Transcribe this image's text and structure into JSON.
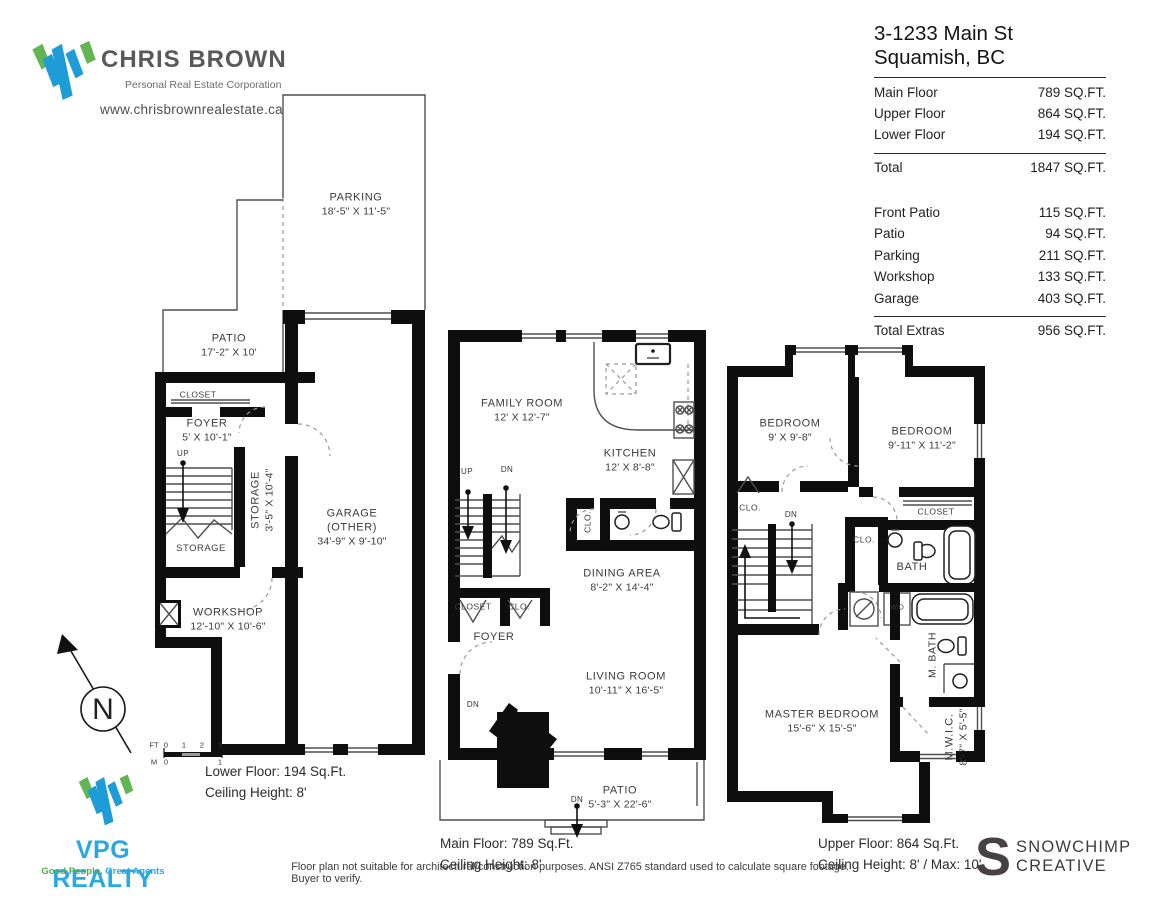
{
  "branding": {
    "agent_logo_name": "CHRIS BROWN",
    "agent_logo_subtitle": "Personal Real Estate Corporation",
    "agent_website": "www.chrisbrownrealestate.ca",
    "brokerage_name": "VPG REALTY",
    "brokerage_tagline_good": "Good People,",
    "brokerage_tagline_great": " Great Agents",
    "designer_initial": "S",
    "designer_name_line1": "SNOWCHIMP",
    "designer_name_line2": "CREATIVE",
    "colors": {
      "logo_blue": "#1e9cd7",
      "logo_green": "#63b553",
      "vpg_blue": "#29a9e1",
      "wall_black": "#0e0e0e"
    }
  },
  "header": {
    "address_line1": "3-1233 Main St",
    "address_line2": "Squamish, BC",
    "floors": [
      {
        "label": "Main Floor",
        "value": "789 SQ.FT."
      },
      {
        "label": "Upper Floor",
        "value": "864 SQ.FT."
      },
      {
        "label": "Lower Floor",
        "value": "194 SQ.FT."
      }
    ],
    "total": {
      "label": "Total",
      "value": "1847 SQ.FT."
    },
    "extras": [
      {
        "label": "Front Patio",
        "value": "115 SQ.FT."
      },
      {
        "label": "Patio",
        "value": "94 SQ.FT."
      },
      {
        "label": "Parking",
        "value": "211 SQ.FT."
      },
      {
        "label": "Workshop",
        "value": "133 SQ.FT."
      },
      {
        "label": "Garage",
        "value": "403 SQ.FT."
      }
    ],
    "total_extras": {
      "label": "Total Extras",
      "value": "956 SQ.FT."
    }
  },
  "plans": {
    "lower": {
      "parking": {
        "name": "PARKING",
        "dims": "18'-5\" X 11'-5\""
      },
      "patio": {
        "name": "PATIO",
        "dims": "17'-2\" X 10'"
      },
      "closet": {
        "name": "CLOSET"
      },
      "foyer": {
        "name": "FOYER",
        "dims": "5' X 10'-1\""
      },
      "storage_tall": {
        "name": "STORAGE",
        "dims": "3'-5\" X 10'-4\""
      },
      "storage": {
        "name": "STORAGE"
      },
      "garage": {
        "name": "GARAGE",
        "name2": "(OTHER)",
        "dims": "34'-9\" X 9'-10\""
      },
      "workshop": {
        "name": "WORKSHOP",
        "dims": "12'-10\" X 10'-6\""
      },
      "caption1": "Lower Floor: 194 Sq.Ft.",
      "caption2": "Ceiling Height: 8'"
    },
    "main": {
      "family": {
        "name": "FAMILY ROOM",
        "dims": "12' X 12'-7\""
      },
      "kitchen": {
        "name": "KITCHEN",
        "dims": "12' X 8'-8\""
      },
      "clo_rot": {
        "name": "CLO."
      },
      "dining": {
        "name": "DINING AREA",
        "dims": "8'-2\" X 14'-4\""
      },
      "closet": {
        "name": "CLOSET"
      },
      "clo": {
        "name": "CLO."
      },
      "foyer": {
        "name": "FOYER"
      },
      "living": {
        "name": "LIVING ROOM",
        "dims": "10'-11\" X 16'-5\""
      },
      "patio": {
        "name": "PATIO",
        "dims": "5'-3\" X 22'-6\""
      },
      "caption1": "Main Floor: 789 Sq.Ft.",
      "caption2": "Ceiling Height: 8'"
    },
    "upper": {
      "bedroom1": {
        "name": "BEDROOM",
        "dims": "9' X 9'-8\""
      },
      "bedroom2": {
        "name": "BEDROOM",
        "dims": "9'-11\" X 11'-2\""
      },
      "clo1": {
        "name": "CLO."
      },
      "closet": {
        "name": "CLOSET"
      },
      "clo2": {
        "name": "CLO."
      },
      "bath": {
        "name": "BATH"
      },
      "wd": {
        "name": "W/D"
      },
      "mbath": {
        "name": "M. BATH"
      },
      "master": {
        "name": "MASTER BEDROOM",
        "dims": "15'-6\" X 15'-5\""
      },
      "mwic": {
        "name": "M.W.I.C.",
        "dims": "8'-7\" X 5'-5\""
      },
      "caption1": "Upper Floor: 864 Sq.Ft.",
      "caption2": "Ceiling Height: 8' / Max: 10'"
    }
  },
  "stairs": {
    "up": "UP",
    "dn": "DN"
  },
  "compass": {
    "north": "N"
  },
  "scalebar": {
    "ft": "FT",
    "m": "M",
    "ft0": "0",
    "ft1": "1",
    "ft2": "2",
    "ft3": "3",
    "m0": "0",
    "m1": "1"
  },
  "disclaimer": "Floor plan not suitable for architectural/construction purposes. ANSI Z765 standard used to calculate square footage. Buyer to verify."
}
